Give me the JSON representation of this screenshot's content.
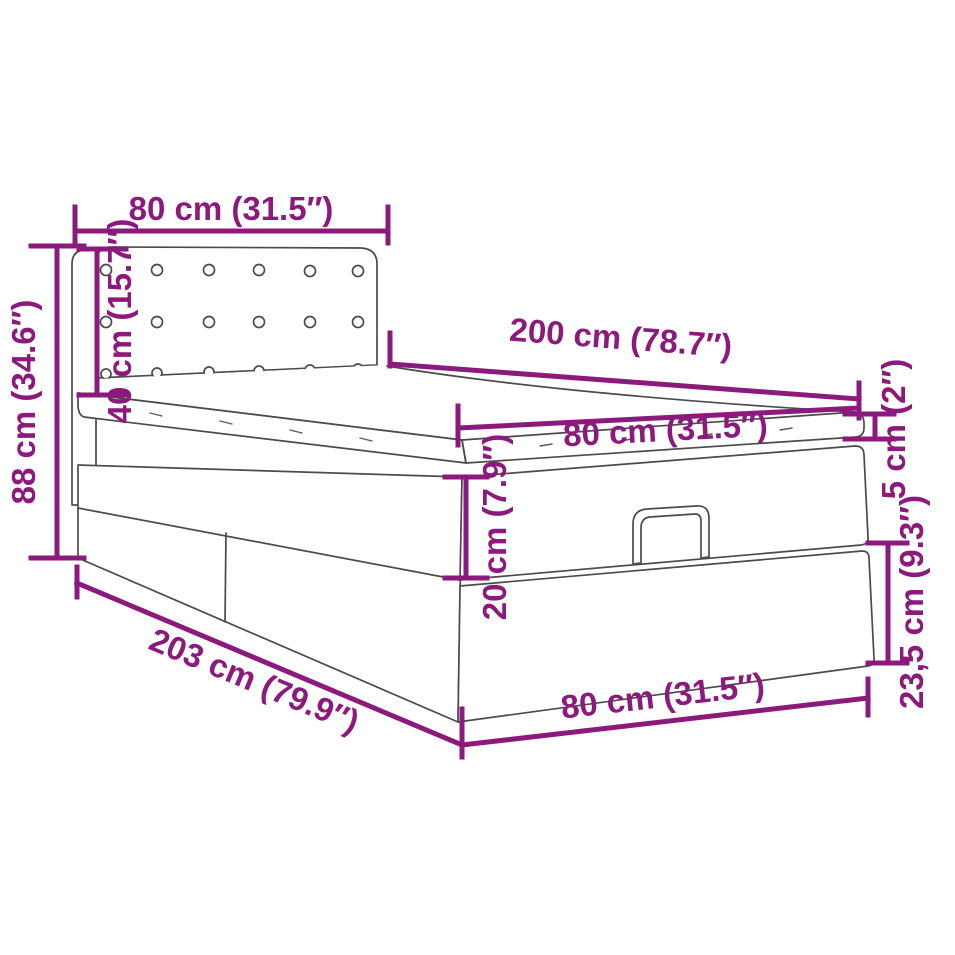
{
  "diagram": {
    "kind": "Dimension diagram of an ottoman storage bed with tufted headboard",
    "dimensions": {
      "headboard_width": {
        "label": "80 cm (31.5″)"
      },
      "headboard_height": {
        "label": "40 cm (15.7″)"
      },
      "total_height": {
        "label": "88 cm (34.6″)"
      },
      "bed_length": {
        "label": "200 cm (78.7″)"
      },
      "mattress_width": {
        "label": "80 cm (31.5″)"
      },
      "mattress_thickness": {
        "label": "5 cm (2″)"
      },
      "lid_section_height": {
        "label": "20 cm (7.9″)"
      },
      "base_length": {
        "label": "203 cm (79.9″)"
      },
      "lower_section_height": {
        "label": "23,5 cm (9.3″)"
      },
      "foot_end_width": {
        "label": "80 cm (31.5″)"
      }
    },
    "colors": {
      "dimension_accent": "#8c1a7d",
      "line_art": "#4b4b4b",
      "background": "#ffffff"
    }
  }
}
